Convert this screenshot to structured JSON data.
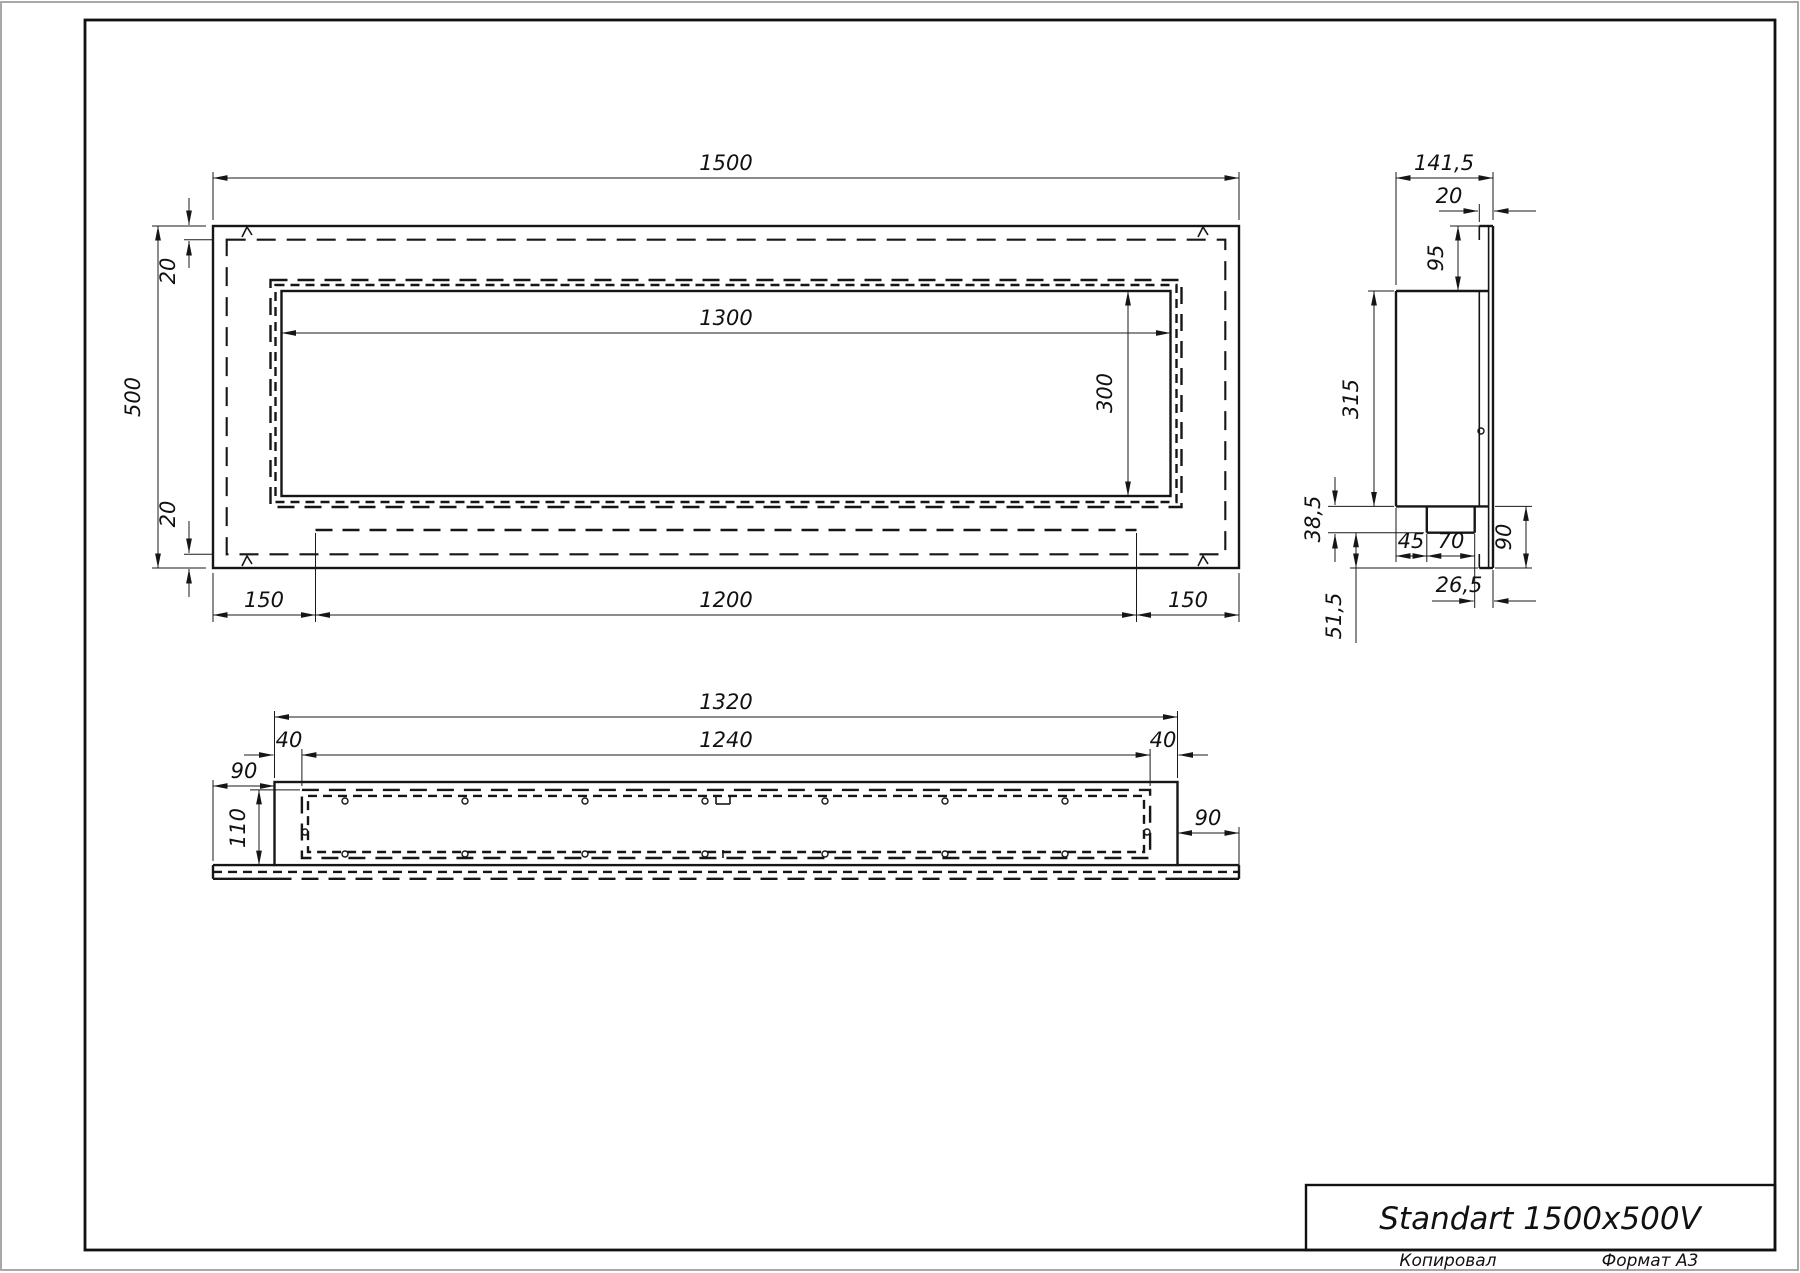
{
  "title_block": {
    "title": "Standart 1500x500V"
  },
  "footer": {
    "copied_label": "Копировал",
    "format_label": "Формат A3"
  },
  "front_view": {
    "dims": {
      "overall_width": "1500",
      "overall_height": "500",
      "flange_top": "20",
      "flange_bottom": "20",
      "opening_width": "1300",
      "opening_height": "300",
      "margin_left": "150",
      "slot_width": "1200",
      "margin_right": "150"
    }
  },
  "side_view": {
    "dims": {
      "overall_depth": "141,5",
      "flange_depth": "20",
      "top_offset": "95",
      "body_height": "315",
      "tray_depth": "38,5",
      "tray_back_offset": "45",
      "tray_width": "70",
      "front_overhang": "90",
      "tray_front_gap": "26,5",
      "bottom_gap": "51,5"
    }
  },
  "bottom_view": {
    "dims": {
      "body_length": "1320",
      "inner_length": "1240",
      "end_wall_left": "40",
      "end_wall_right": "40",
      "overhang_left": "90",
      "overhang_right": "90",
      "depth": "110"
    }
  }
}
